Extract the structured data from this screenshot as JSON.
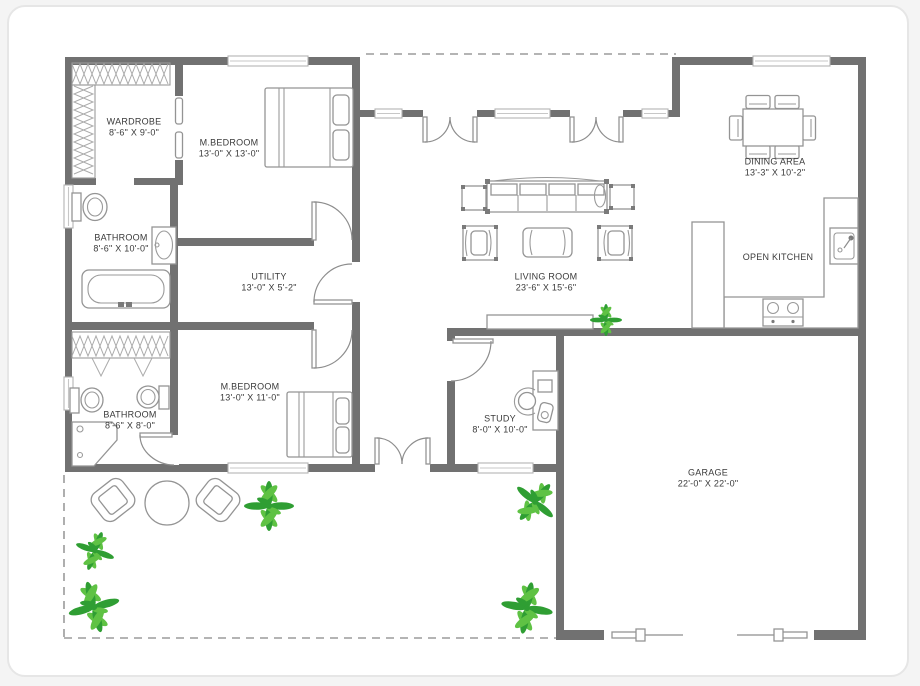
{
  "plan": {
    "type": "house-floor-plan",
    "colors": {
      "wall": "#717171",
      "furniture_line": "#949494",
      "window_fill": "#d9d9d9",
      "plant_dark": "#2f9e33",
      "plant_light": "#5fc244",
      "label_text": "#3a3a3a",
      "card_border": "#e6e6e6",
      "page_background": "#f4f4f4"
    },
    "icons": [
      "plant-icon",
      "sofa",
      "armchair",
      "coffee-table",
      "side-table",
      "dining-table",
      "dining-chair",
      "bed",
      "wardrobe-rail",
      "toilet",
      "sink",
      "bathtub",
      "shower",
      "kitchen-sink",
      "stove",
      "desk",
      "desk-chair",
      "patio-chair",
      "patio-table",
      "door-swing",
      "window",
      "garage-door",
      "sideboard"
    ]
  },
  "rooms": [
    {
      "id": "wardrobe",
      "name": "WARDROBE",
      "dims": "8'-6\" X 9'-0\""
    },
    {
      "id": "master-bedroom-1",
      "name": "M.BEDROOM",
      "dims": "13'-0\" X 13'-0\""
    },
    {
      "id": "bathroom-1",
      "name": "BATHROOM",
      "dims": "8'-6\" X 10'-0\""
    },
    {
      "id": "utility",
      "name": "UTILITY",
      "dims": "13'-0\" X 5'-2\""
    },
    {
      "id": "living-room",
      "name": "LIVING ROOM",
      "dims": "23'-6\" X 15'-6\""
    },
    {
      "id": "dining-area",
      "name": "DINING AREA",
      "dims": "13'-3\" X 10'-2\""
    },
    {
      "id": "open-kitchen",
      "name": "OPEN KITCHEN",
      "dims": ""
    },
    {
      "id": "bathroom-2",
      "name": "BATHROOM",
      "dims": "8'-6\" X 8'-0\""
    },
    {
      "id": "master-bedroom-2",
      "name": "M.BEDROOM",
      "dims": "13'-0\" X 11'-0\""
    },
    {
      "id": "study",
      "name": "STUDY",
      "dims": "8'-0\" X 10'-0\""
    },
    {
      "id": "garage",
      "name": "GARAGE",
      "dims": "22'-0\" X 22'-0\""
    }
  ]
}
